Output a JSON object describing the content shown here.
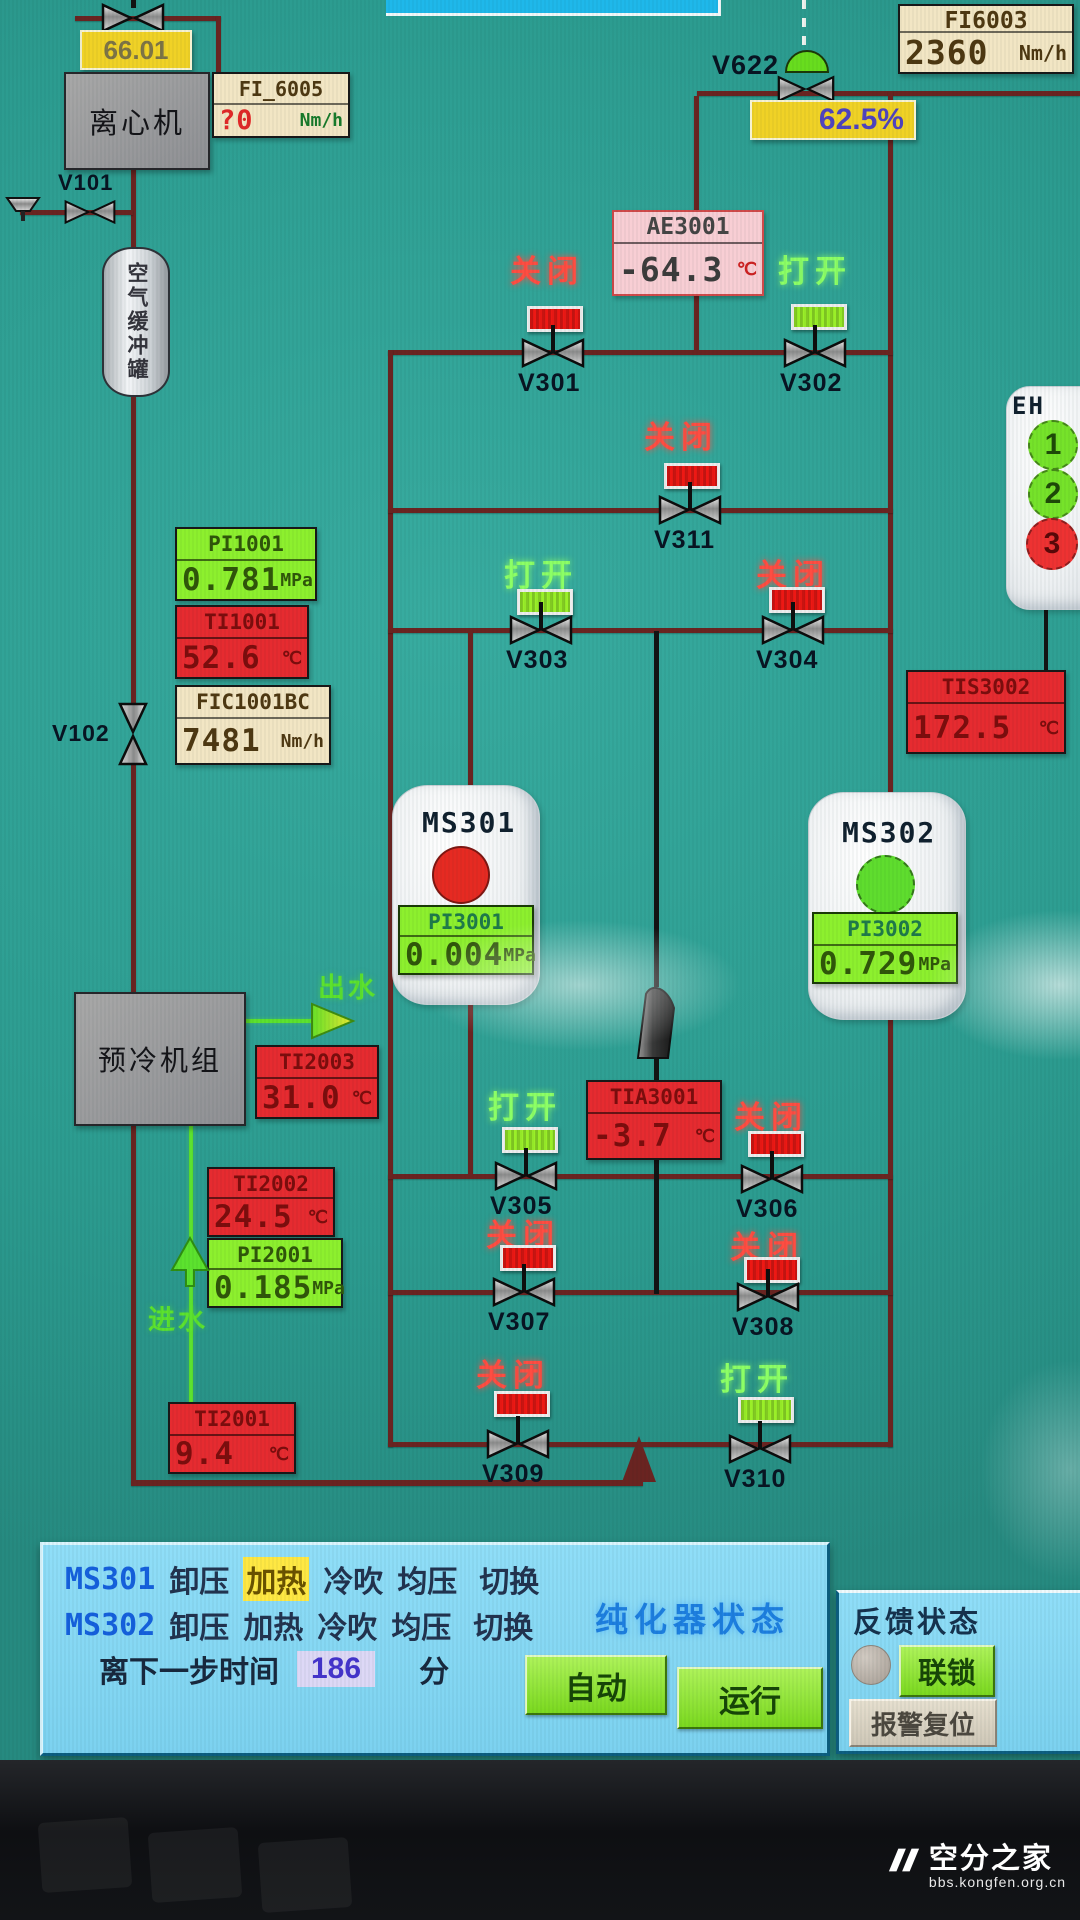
{
  "colors": {
    "background": "#2d9f93",
    "pipe": "#6a2421",
    "open_text": "#8cff66",
    "closed_text": "#ff4d42",
    "open_indicator": "#9aef28",
    "closed_indicator": "#ee1814",
    "highlight_step_bg": "#ffe843",
    "yellow_box_bg": "#f0d226",
    "panel_bg": "#85d8f4"
  },
  "labels": {
    "centrifuge": "离心机",
    "buffer_tank": "空气缓冲罐",
    "precool": "预冷机组",
    "water_out": "出水",
    "water_in": "进水",
    "v101": "V101",
    "v102": "V102",
    "v622": "V622",
    "v622_opening": "62.5%",
    "top_valve_value": "66.01"
  },
  "ms": {
    "ms301": {
      "label": "MS301",
      "circle_color": "#e62a22"
    },
    "ms302": {
      "label": "MS302",
      "circle_color": "#5fdd2e"
    }
  },
  "eh": {
    "title": "EH",
    "stages": [
      {
        "n": "1",
        "color": "#76e32a",
        "fg": "#1e4a08"
      },
      {
        "n": "2",
        "color": "#76e32a",
        "fg": "#1e4a08"
      },
      {
        "n": "3",
        "color": "#ee3232",
        "fg": "#5a0808"
      }
    ]
  },
  "instruments": {
    "fi_6005": {
      "tag": "FI_6005",
      "value": "?0",
      "unit": "Nm/h",
      "value_color": "#e02828",
      "unit_color": "#177a2a"
    },
    "fi6003": {
      "tag": "FI6003",
      "value": "2360",
      "unit": "Nm/h"
    },
    "pi1001": {
      "tag": "PI1001",
      "value": "0.781",
      "unit": "MPa"
    },
    "ti1001": {
      "tag": "TI1001",
      "value": "52.6",
      "unit": "℃"
    },
    "fic1001bc": {
      "tag": "FIC1001BC",
      "value": "7481",
      "unit": "Nm/h"
    },
    "ae3001": {
      "tag": "AE3001",
      "value": "-64.3",
      "unit": "℃",
      "unit_color": "#cc2222"
    },
    "tis3002": {
      "tag": "TIS3002",
      "value": "172.5",
      "unit": "℃"
    },
    "pi3001": {
      "tag": "PI3001",
      "value": "0.004",
      "unit": "MPa"
    },
    "pi3002": {
      "tag": "PI3002",
      "value": "0.729",
      "unit": "MPa"
    },
    "tia3001": {
      "tag": "TIA3001",
      "value": "-3.7",
      "unit": "℃"
    },
    "ti2003": {
      "tag": "TI2003",
      "value": "31.0",
      "unit": "℃"
    },
    "ti2002": {
      "tag": "TI2002",
      "value": "24.5",
      "unit": "℃"
    },
    "pi2001": {
      "tag": "PI2001",
      "value": "0.185",
      "unit": "MPa"
    },
    "ti2001": {
      "tag": "TI2001",
      "value": "9.4",
      "unit": "℃"
    }
  },
  "valves": {
    "v301": {
      "label": "V301",
      "state": "关闭",
      "open": false,
      "state_color": "#ff4d42",
      "ind_color": "#ee1814"
    },
    "v302": {
      "label": "V302",
      "state": "打开",
      "open": true,
      "state_color": "#8cff66",
      "ind_color": "#9aef28"
    },
    "v311": {
      "label": "V311",
      "state": "关闭",
      "open": false,
      "state_color": "#ff4d42",
      "ind_color": "#ee1814"
    },
    "v303": {
      "label": "V303",
      "state": "打开",
      "open": true,
      "state_color": "#8cff66",
      "ind_color": "#9aef28"
    },
    "v304": {
      "label": "V304",
      "state": "关闭",
      "open": false,
      "state_color": "#ff4d42",
      "ind_color": "#ee1814"
    },
    "v305": {
      "label": "V305",
      "state": "打开",
      "open": true,
      "state_color": "#8cff66",
      "ind_color": "#9aef28"
    },
    "v306": {
      "label": "V306",
      "state": "关闭",
      "open": false,
      "state_color": "#ff4d42",
      "ind_color": "#ee1814"
    },
    "v307": {
      "label": "V307",
      "state": "关闭",
      "open": false,
      "state_color": "#ff4d42",
      "ind_color": "#ee1814"
    },
    "v308": {
      "label": "V308",
      "state": "关闭",
      "open": false,
      "state_color": "#ff4d42",
      "ind_color": "#ee1814"
    },
    "v309": {
      "label": "V309",
      "state": "关闭",
      "open": false,
      "state_color": "#ff4d42",
      "ind_color": "#ee1814"
    },
    "v310": {
      "label": "V310",
      "state": "打开",
      "open": true,
      "state_color": "#8cff66",
      "ind_color": "#9aef28"
    }
  },
  "panel": {
    "seq1": {
      "tag": "MS301",
      "steps": [
        "卸压",
        "加热",
        "冷吹",
        "均压",
        "切换"
      ],
      "active_step": "加热"
    },
    "seq2": {
      "tag": "MS302",
      "steps": [
        "卸压",
        "加热",
        "冷吹",
        "均压",
        "切换"
      ],
      "active_step": ""
    },
    "timer_label": "离下一步时间",
    "timer_value": "186",
    "timer_unit": "分",
    "status_title": "纯化器状态",
    "auto": "自动",
    "run": "运行",
    "feedback_title": "反馈状态",
    "interlock": "联锁",
    "alarm_reset": "报警复位"
  },
  "watermark": {
    "brand": "空分之家",
    "url": "bbs.kongfen.org.cn"
  }
}
